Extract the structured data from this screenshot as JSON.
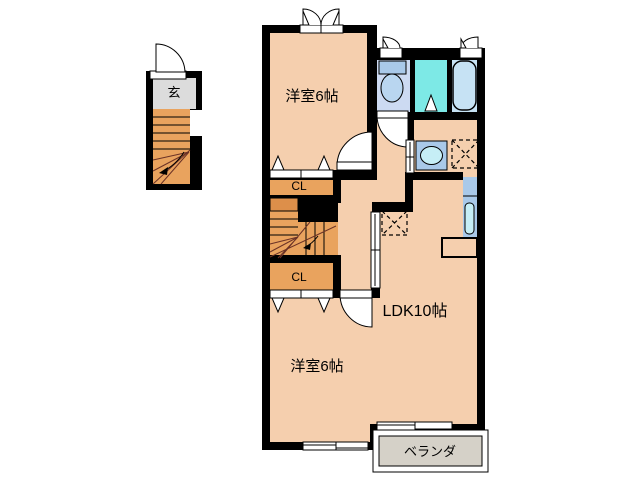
{
  "plan": {
    "labels": {
      "entrance": "玄",
      "bedroom_top": "洋室6帖",
      "closet_top": "CL",
      "closet_bottom": "CL",
      "bedroom_bottom": "洋室6帖",
      "ldk": "LDK10帖",
      "veranda": "ベランダ"
    },
    "colors": {
      "wall": "#000000",
      "floor_room": "#f5cfae",
      "floor_closet_stairs": "#e9a35e",
      "stair_landing": "#dd8f4a",
      "floor_entrance": "#dcdcdc",
      "floor_veranda": "#d5d1c8",
      "floor_toilet": "#ccdaf2",
      "floor_bathroom": "#7de9e6",
      "floor_bathtub": "#c6e2f4",
      "fixture_blue": "#a9c9e9",
      "fixture_light": "#c6eef6",
      "toilet_bowl": "#b9d6f0",
      "bathtub_fill": "#c2e8f8",
      "stair_guide_line": "#6b3226",
      "background": "#ffffff"
    },
    "fixtures": [
      "entrance-door",
      "staircase-1f",
      "staircase-2f",
      "double-casement-window",
      "casement-window",
      "sliding-window",
      "toilet",
      "bathtub",
      "bathroom-door",
      "washbasin",
      "washing-machine-pan",
      "refrigerator-pan",
      "kitchen-sink",
      "kitchen-counter",
      "veranda-sliding-door",
      "hallway-sliding-door"
    ]
  }
}
